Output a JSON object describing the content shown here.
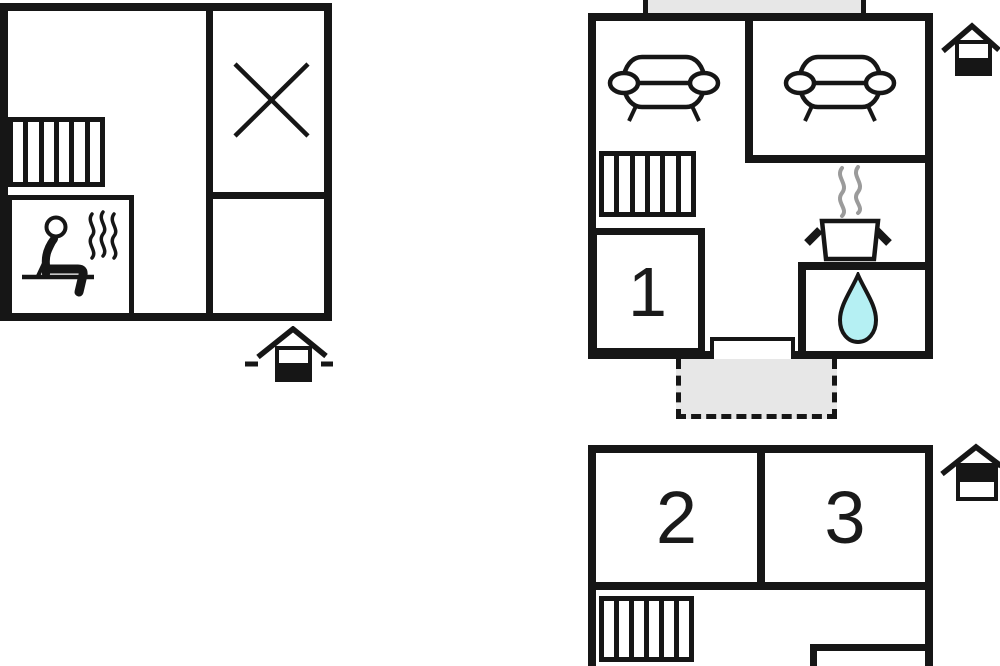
{
  "page_title": "Property floor plan",
  "rooms": {
    "room1": "1",
    "room2": "2",
    "room3": "3"
  },
  "levels": [
    {
      "id": "basement",
      "icon": "house-level-basement-icon",
      "features": [
        "radiator",
        "sauna-room",
        "person-in-sauna-icon",
        "heat-waves-icon",
        "crossed-out-area-icon"
      ],
      "room_labels": []
    },
    {
      "id": "ground-floor",
      "icon": "house-level-ground-icon",
      "features": [
        "balcony-area",
        "sofa-icon",
        "sofa-icon",
        "radiator",
        "steam-icon",
        "cooking-pot-icon",
        "sink-area",
        "water-drop-icon",
        "door-opening",
        "terrace-area"
      ],
      "room_labels": [
        "1"
      ]
    },
    {
      "id": "first-floor",
      "icon": "house-level-first-icon",
      "features": [
        "radiator",
        "closet-walls"
      ],
      "room_labels": [
        "2",
        "3"
      ]
    }
  ],
  "colors": {
    "wall": "#161616",
    "area_fill": "#e7e7e7",
    "steam": "#9b9b9b",
    "water": "#b5f0f3",
    "background": "#ffffff"
  }
}
